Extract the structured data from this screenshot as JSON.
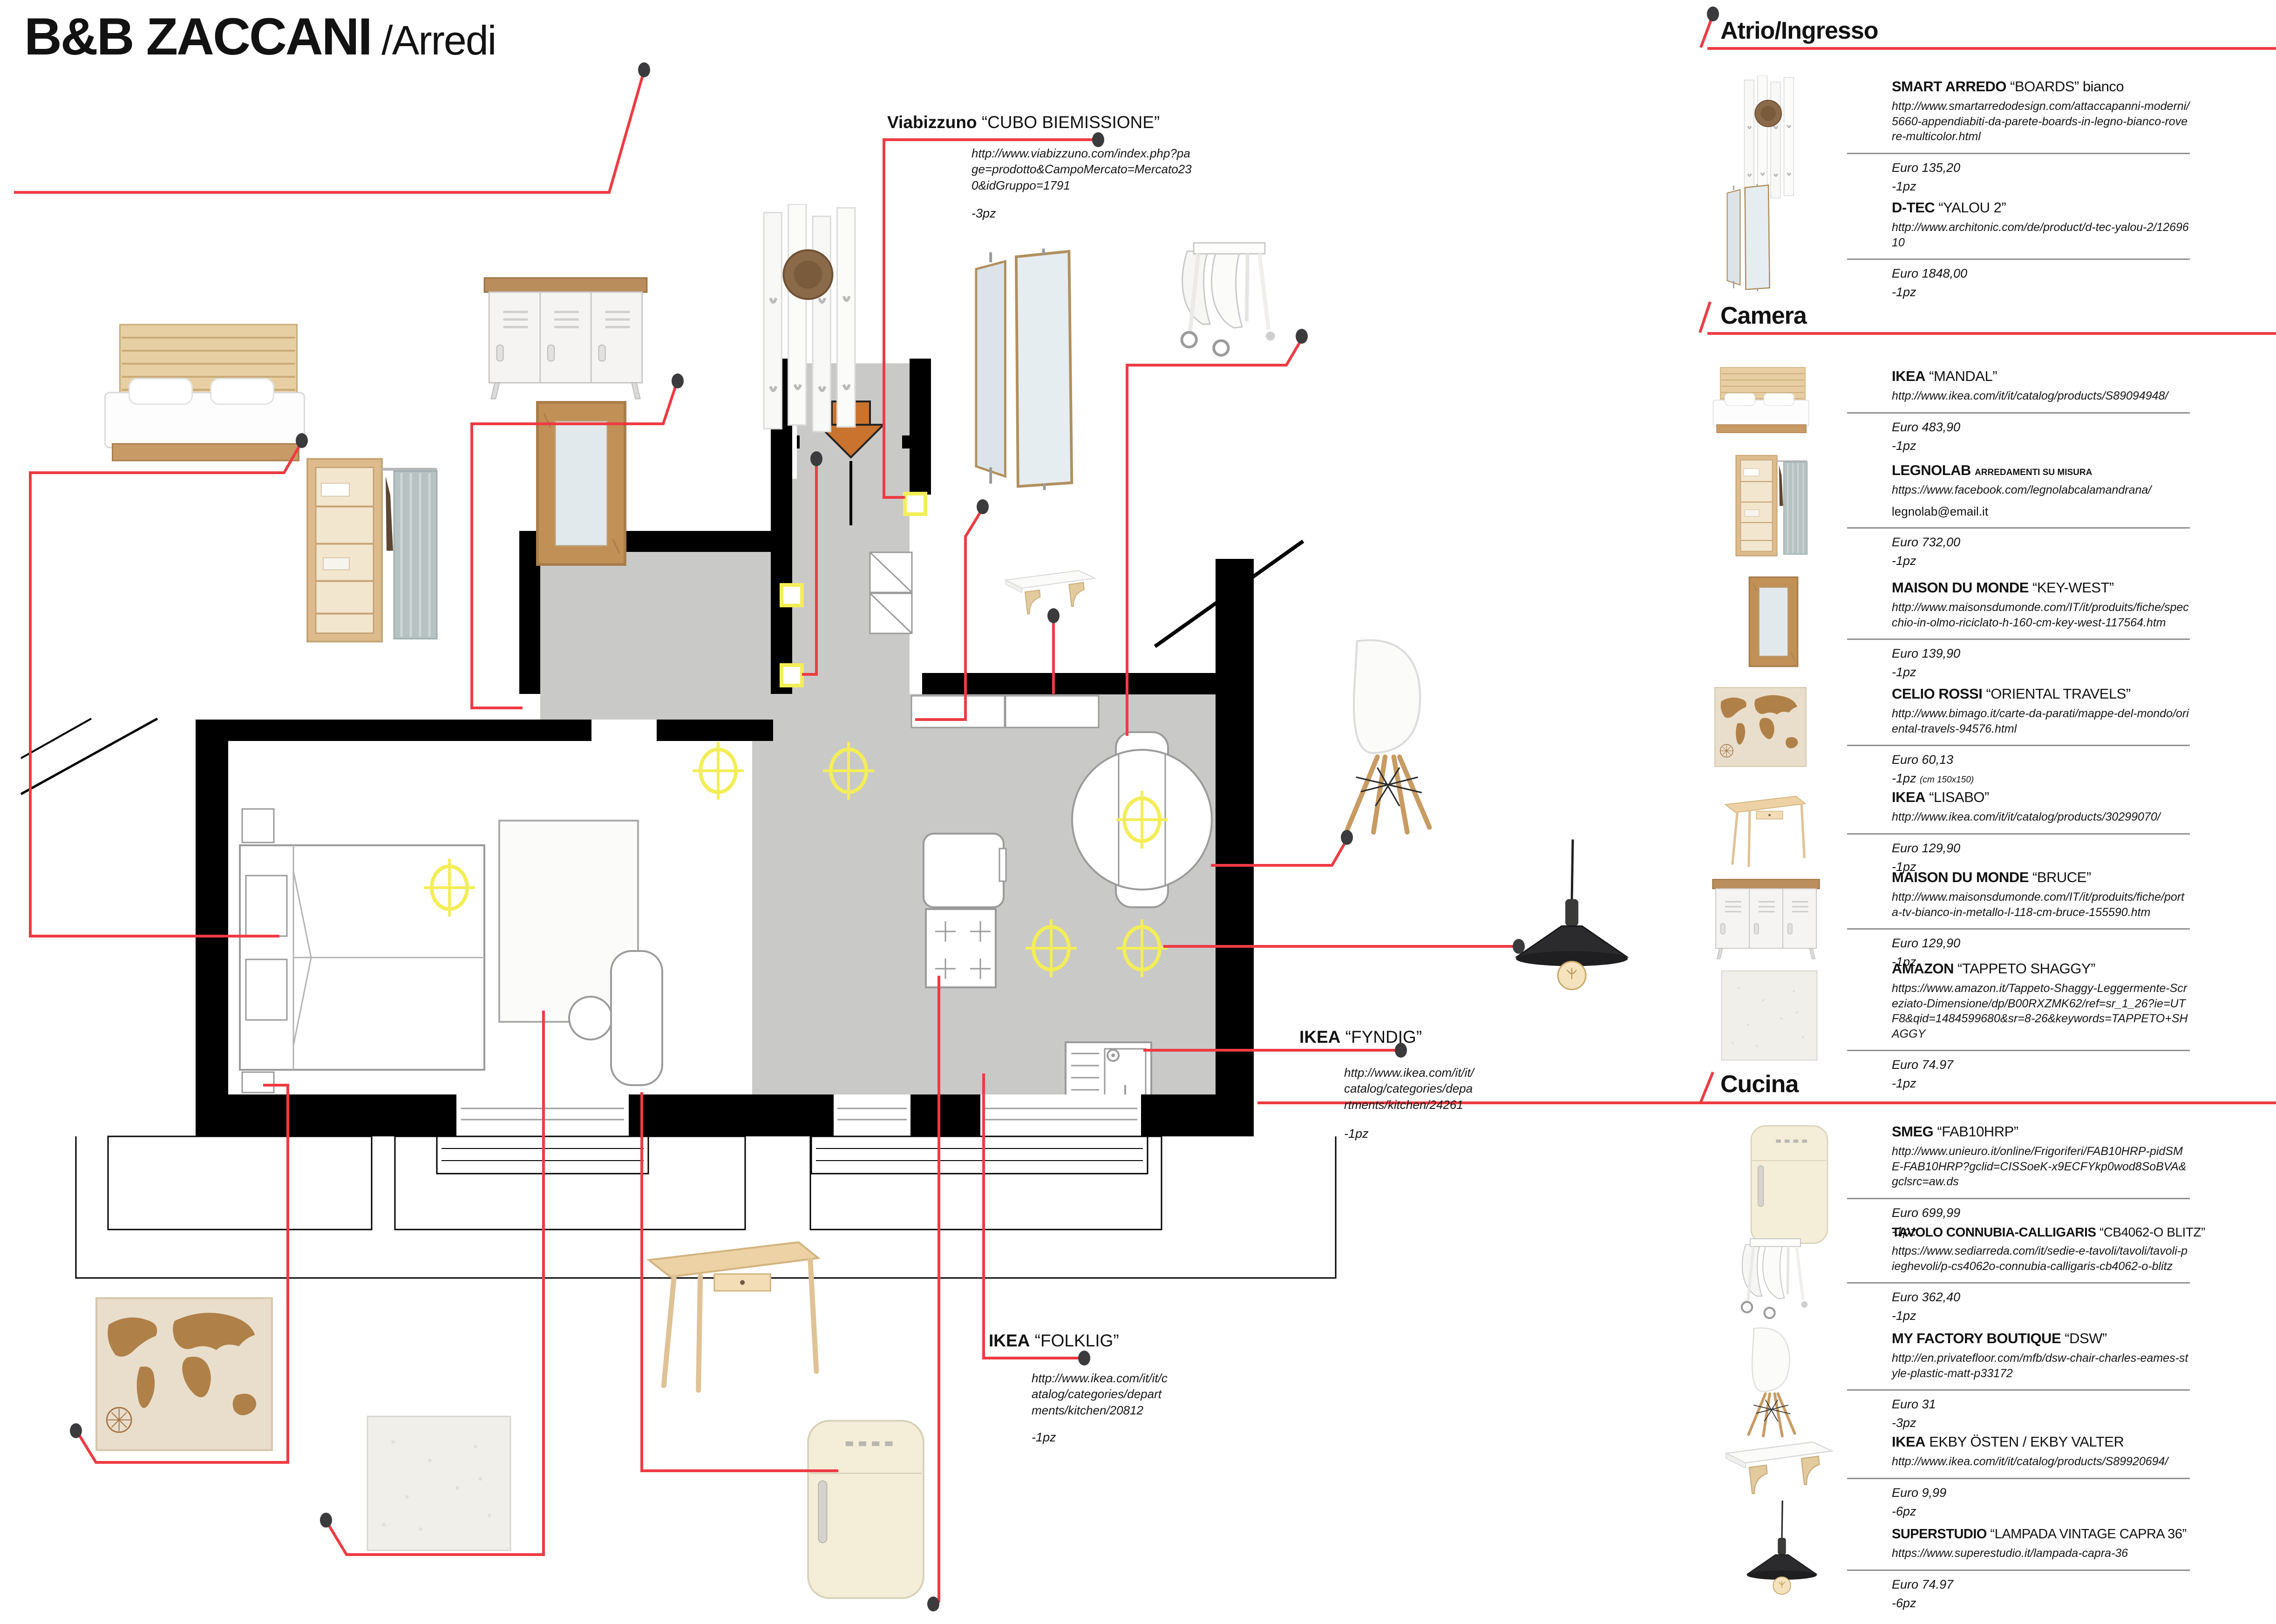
{
  "page": {
    "title_main": "B&B ZACCANI",
    "title_sub": " /Arredi"
  },
  "plan_annotations": {
    "viabizzuno": {
      "brand": "Viabizzuno",
      "product": "“CUBO BIEMISSIONE”",
      "url": "http://www.viabizzuno.com/index.php?page=prodotto&CampoMercato=Mercato230&idGruppo=1791",
      "qty": "-3pz"
    },
    "fyndig": {
      "brand": "IKEA",
      "product": "“FYNDIG”",
      "url": "http://www.ikea.com/it/it/catalog/categories/departments/kitchen/24261",
      "qty": "-1pz"
    },
    "folklig": {
      "brand": "IKEA",
      "product": "“FOLKLIG”",
      "url": "http://www.ikea.com/it/it/catalog/categories/departments/kitchen/20812",
      "qty": "-1pz"
    }
  },
  "sidebar": {
    "sections": [
      {
        "title": "Atrio/Ingresso",
        "items": [
          {
            "brand": "SMART ARREDO",
            "product": "“BOARDS” bianco",
            "suffix": "",
            "url": "http://www.smartarredodesign.com/attaccapanni-moderni/5660-appendiabiti-da-parete-boards-in-legno-bianco-rovere-multicolor.html",
            "email": "",
            "price": "Euro 135,20",
            "qty": "-1pz",
            "note": ""
          },
          {
            "brand": "D-TEC",
            "product": "“YALOU 2”",
            "suffix": "",
            "url": "http://www.architonic.com/de/product/d-tec-yalou-2/1269610",
            "email": "",
            "price": "Euro 1848,00",
            "qty": "-1pz",
            "note": ""
          }
        ]
      },
      {
        "title": "Camera",
        "items": [
          {
            "brand": "IKEA",
            "product": "“MANDAL”",
            "suffix": "",
            "url": "http://www.ikea.com/it/it/catalog/products/S89094948/",
            "email": "",
            "price": "Euro 483,90",
            "qty": "-1pz",
            "note": ""
          },
          {
            "brand": "LEGNOLAB",
            "product": "",
            "suffix": "ARREDAMENTI SU MISURA",
            "url": "https://www.facebook.com/legnolabcalamandrana/",
            "email": "legnolab@email.it",
            "price": "Euro 732,00",
            "qty": "-1pz",
            "note": ""
          },
          {
            "brand": "MAISON DU MONDE",
            "product": "“KEY-WEST”",
            "suffix": "",
            "url": "http://www.maisonsdumonde.com/IT/it/produits/fiche/specchio-in-olmo-riciclato-h-160-cm-key-west-117564.htm",
            "email": "",
            "price": "Euro 139,90",
            "qty": "-1pz",
            "note": ""
          },
          {
            "brand": "CELIO ROSSI",
            "product": "“ORIENTAL TRAVELS”",
            "suffix": "",
            "url": "http://www.bimago.it/carte-da-parati/mappe-del-mondo/oriental-travels-94576.html",
            "email": "",
            "price": "Euro 60,13",
            "qty": "-1pz",
            "note": "(cm 150x150)"
          },
          {
            "brand": "IKEA",
            "product": "“LISABO”",
            "suffix": "",
            "url": "http://www.ikea.com/it/it/catalog/products/30299070/",
            "email": "",
            "price": "Euro 129,90",
            "qty": "-1pz",
            "note": ""
          },
          {
            "brand": "MAISON DU MONDE",
            "product": "“BRUCE”",
            "suffix": "",
            "url": "http://www.maisonsdumonde.com/IT/it/produits/fiche/porta-tv-bianco-in-metallo-l-118-cm-bruce-155590.htm",
            "email": "",
            "price": "Euro 129,90",
            "qty": "-1pz",
            "note": ""
          },
          {
            "brand": "AMAZON",
            "product": "“TAPPETO SHAGGY”",
            "suffix": "",
            "url": "https://www.amazon.it/Tappeto-Shaggy-Leggermente-Screziato-Dimensione/dp/B00RXZMK62/ref=sr_1_26?ie=UTF8&qid=1484599680&sr=8-26&keywords=TAPPETO+SHAGGY",
            "email": "",
            "price": "Euro 74.97",
            "qty": "-1pz",
            "note": ""
          }
        ]
      },
      {
        "title": "Cucina",
        "items": [
          {
            "brand": "SMEG",
            "product": "“FAB10HRP”",
            "suffix": "",
            "url": "http://www.unieuro.it/online/Frigoriferi/FAB10HRP-pidSME-FAB10HRP?gclid=CISSoeK-x9ECFYkp0wod8SoBVA&gclsrc=aw.ds",
            "email": "",
            "price": "Euro 699,99",
            "qty": "-1pz",
            "note": ""
          },
          {
            "brand": "TAVOLO CONNUBIA-CALLIGARIS",
            "product": "“CB4062-O BLITZ”",
            "suffix": "",
            "url": "https://www.sediarreda.com/it/sedie-e-tavoli/tavoli/tavoli-pieghevoli/p-cs4062o-connubia-calligaris-cb4062-o-blitz",
            "email": "",
            "price": "Euro 362,40",
            "qty": "-1pz",
            "note": ""
          },
          {
            "brand": "MY FACTORY BOUTIQUE",
            "product": "“DSW”",
            "suffix": "",
            "url": "http://en.privatefloor.com/mfb/dsw-chair-charles-eames-style-plastic-matt-p33172",
            "email": "",
            "price": "Euro 31",
            "qty": "-3pz",
            "note": ""
          },
          {
            "brand": "IKEA",
            "product": "EKBY ÖSTEN / EKBY VALTER",
            "suffix": "",
            "url": "http://www.ikea.com/it/it/catalog/products/S89920694/",
            "email": "",
            "price": "Euro 9,99",
            "qty": "-6pz",
            "note": ""
          },
          {
            "brand": "SUPERSTUDIO",
            "product": "“LAMPADA VINTAGE CAPRA 36”",
            "suffix": "",
            "url": "https://www.superestudio.it/lampada-capra-36",
            "email": "",
            "price": "Euro 74.97",
            "qty": "-6pz",
            "note": ""
          }
        ]
      }
    ]
  }
}
